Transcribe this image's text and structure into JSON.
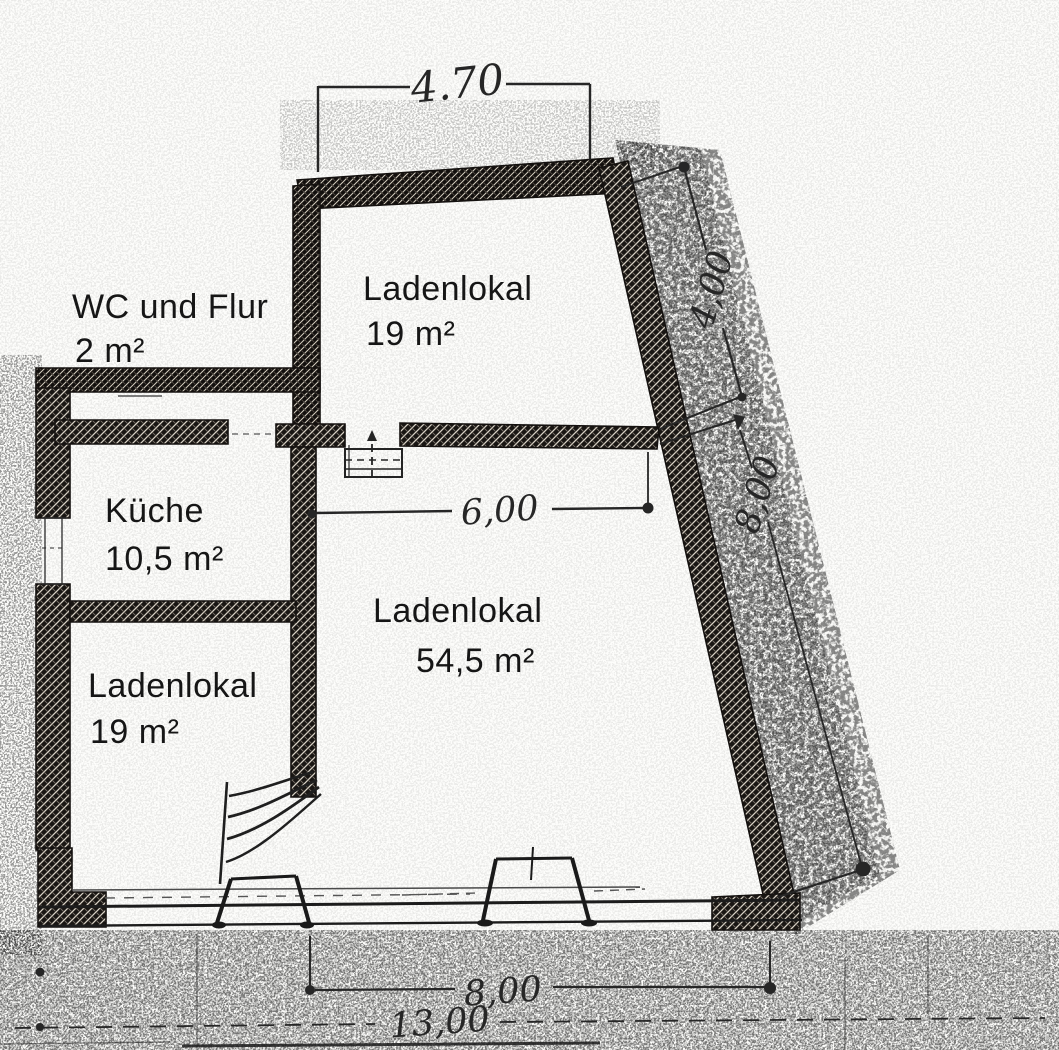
{
  "document": {
    "kind": "scanned floor plan",
    "language": "de"
  },
  "rooms": [
    {
      "id": "wc-flur",
      "name": "WC und Flur",
      "area": "2 m²"
    },
    {
      "id": "laden-top",
      "name": "Ladenlokal",
      "area": "19 m²"
    },
    {
      "id": "kueche",
      "name": "Küche",
      "area": "10,5 m²"
    },
    {
      "id": "laden-left",
      "name": "Ladenlokal",
      "area": "19 m²"
    },
    {
      "id": "laden-main",
      "name": "Ladenlokal",
      "area": "54,5 m²"
    }
  ],
  "dimensions": {
    "top_width": "4.70",
    "inner_width": "6,00",
    "right_upper": "4,00",
    "right_lower": "8,00",
    "bottom_width": "8,00",
    "total_width": "13,00"
  },
  "colors": {
    "ink": "#1c1c1c",
    "paper": "#fdfdfb"
  }
}
